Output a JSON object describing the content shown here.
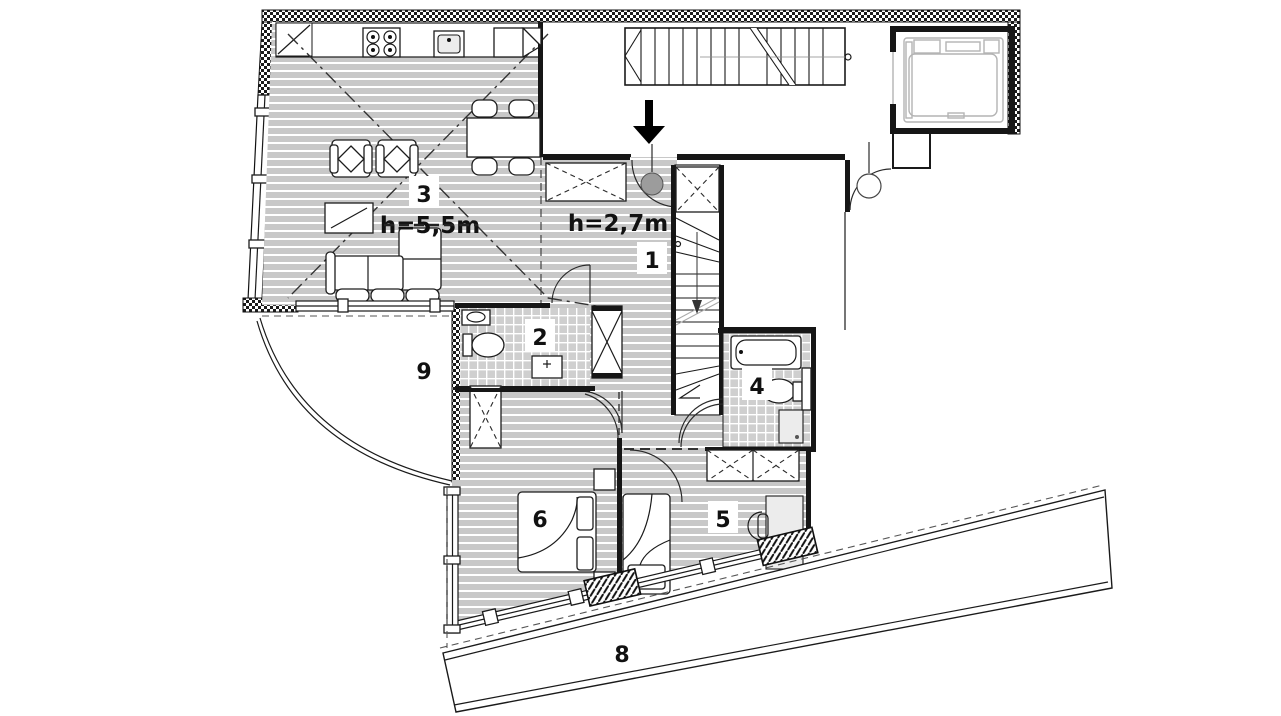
{
  "plan": {
    "type": "apartment-floor-plan",
    "heights": {
      "living": "h=5,5m",
      "hall": "h=2,7m"
    },
    "rooms": [
      {
        "number": "1",
        "note": "hall"
      },
      {
        "number": "2",
        "note": "wc"
      },
      {
        "number": "3",
        "note": "living-kitchen"
      },
      {
        "number": "4",
        "note": "bathroom"
      },
      {
        "number": "5",
        "note": "bedroom"
      },
      {
        "number": "6",
        "note": "bedroom"
      },
      {
        "number": "8",
        "note": "terrace"
      },
      {
        "number": "9",
        "note": "balcony"
      }
    ],
    "icons": {
      "entrance_arrow": "arrow-down",
      "stair_up": "staircase",
      "elevator": "elevator-cab",
      "stove": "4-burner-hob",
      "sink": "kitchen-sink",
      "bathtub": "bathtub",
      "toilet": "toilet",
      "washer": "washing-machine"
    },
    "colors": {
      "paper": "#ffffff",
      "floor_stripe": "#c8c8c8",
      "tile": "#d0d0d0",
      "wall": "#161616",
      "lift_outline": "#b4b4b4",
      "entry_circle": "#9c9c9c"
    }
  }
}
